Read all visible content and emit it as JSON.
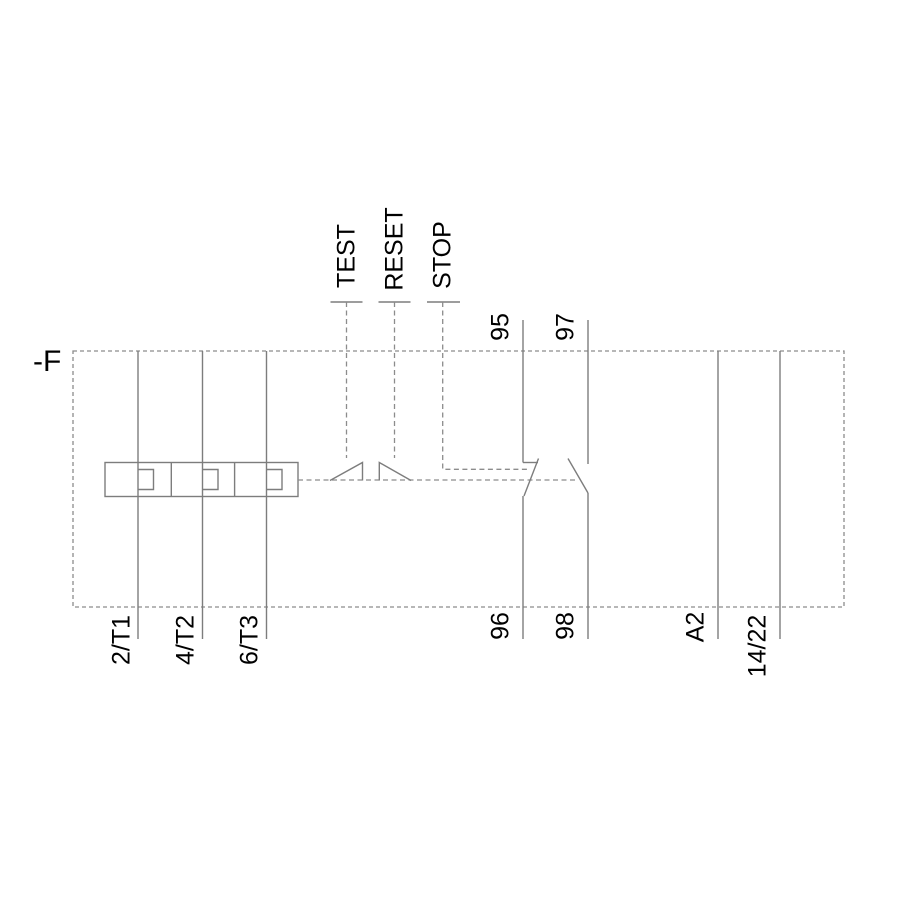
{
  "device": {
    "designation": "-F"
  },
  "controls": {
    "test": "TEST",
    "reset": "RESET",
    "stop": "STOP"
  },
  "terminals": {
    "phase": [
      {
        "label": "2/T1"
      },
      {
        "label": "4/T2"
      },
      {
        "label": "6/T3"
      }
    ],
    "nc_contact": {
      "top": "95",
      "bottom": "96"
    },
    "no_contact": {
      "top": "97",
      "bottom": "98"
    },
    "coil": "A2",
    "aux": "14/22"
  },
  "colors": {
    "line": "#7d7d7d",
    "dash": "#8c8c8c",
    "text": "#000000"
  }
}
